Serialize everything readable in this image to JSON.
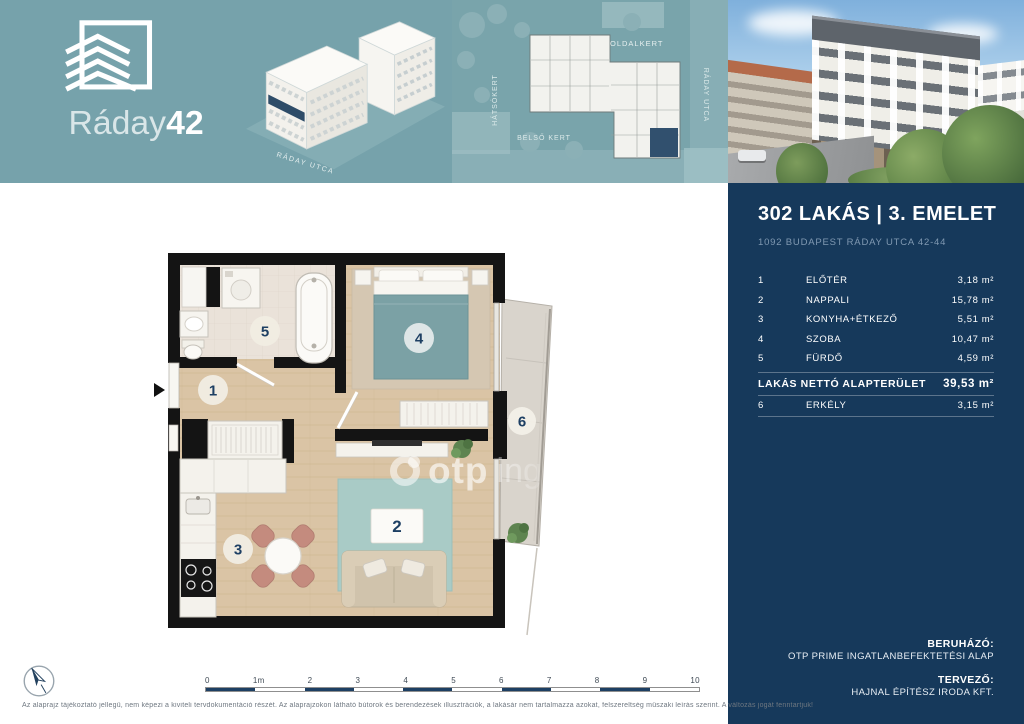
{
  "brand": {
    "name_light": "Ráday",
    "name_bold": "42"
  },
  "header": {
    "axon_street_label": "RÁDAY UTCA",
    "siteplan_labels": {
      "top": "OLDALKERT",
      "left": "HÁTSÓKERT",
      "inner": "BELSŐ KERT",
      "right": "RÁDAY UTCA"
    }
  },
  "sidebar": {
    "title": "302 LAKÁS | 3. EMELET",
    "address": "1092 BUDAPEST RÁDAY UTCA 42-44",
    "unit": "m²",
    "rooms": [
      {
        "num": "1",
        "name": "ELŐTÉR",
        "area": "3,18"
      },
      {
        "num": "2",
        "name": "NAPPALI",
        "area": "15,78"
      },
      {
        "num": "3",
        "name": "KONYHA+ÉTKEZŐ",
        "area": "5,51"
      },
      {
        "num": "4",
        "name": "SZOBA",
        "area": "10,47"
      },
      {
        "num": "5",
        "name": "FÜRDŐ",
        "area": "4,59"
      }
    ],
    "total": {
      "label": "LAKÁS NETTÓ ALAPTERÜLET",
      "area": "39,53"
    },
    "extra": {
      "num": "6",
      "name": "ERKÉLY",
      "area": "3,15"
    },
    "credits": {
      "developer_label": "BERUHÁZÓ:",
      "developer": "OTP PRIME INGATLANBEFEKTETÉSI ALAP",
      "architect_label": "TERVEZŐ:",
      "architect": "HAJNAL ÉPÍTÉSZ IRODA KFT."
    }
  },
  "plan": {
    "room_numbers": {
      "r1": "1",
      "r2": "2",
      "r3": "3",
      "r4": "4",
      "r5": "5",
      "r6": "6"
    },
    "watermark": {
      "bold": "otp",
      "light": "inga"
    }
  },
  "footer": {
    "scale_ticks": [
      "0",
      "1m",
      "2",
      "3",
      "4",
      "5",
      "6",
      "7",
      "8",
      "9",
      "10"
    ],
    "disclaimer": "Az alaprajz tájékoztató jellegű, nem képezi a kiviteli tervdokumentáció részét. Az alaprajzokon látható bútorok és berendezések illusztrációk, a lakásár nem tartalmazza azokat, felszereltség műszaki leírás szerint. A változás jogát fenntartjuk!"
  },
  "colors": {
    "teal_header": "#76a2ab",
    "navy": "#16395b",
    "badge_text": "#1d3f63",
    "wood_floor": "#dac4a5",
    "bed_teal": "#7ba1a5",
    "rug_teal": "#a9cbc6",
    "chair_terracotta": "#c48b7e"
  }
}
